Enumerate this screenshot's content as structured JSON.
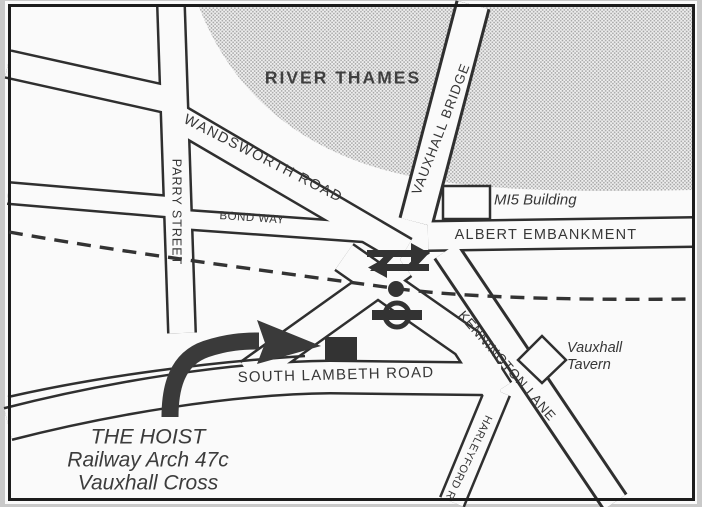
{
  "map": {
    "labels": {
      "river_thames": "RIVER THAMES",
      "wandsworth_road": "WANDSWORTH ROAD",
      "bond_way": "BOND WAY",
      "parry_street": "PARRY STREET",
      "vauxhall_bridge": "VAUXHALL BRIDGE",
      "albert_embankment": "ALBERT EMBANKMENT",
      "mi5_building": "MI5 Building",
      "kennington_lane": "KENNINGTON LANE",
      "south_lambeth_road": "SOUTH LAMBETH ROAD",
      "harleyford_road": "HARLEYFORD R",
      "vauxhall_tavern_line1": "Vauxhall",
      "vauxhall_tavern_line2": "Tavern"
    },
    "venue": {
      "name": "THE HOIST",
      "address_line1": "Railway Arch 47c",
      "address_line2": "Vauxhall Cross"
    },
    "icons": {
      "national_rail": "national-rail-icon",
      "underground": "underground-roundel-icon",
      "station_dot": "station-dot-icon",
      "direction_arrow": "direction-arrow",
      "venue_marker": "venue-marker-square"
    },
    "colors": {
      "ink": "#2f2f2f",
      "paper": "#fafafa",
      "margin": "#c9c9c9",
      "river_dot": "#a3a3a3",
      "river_bg": "#efefef"
    }
  }
}
